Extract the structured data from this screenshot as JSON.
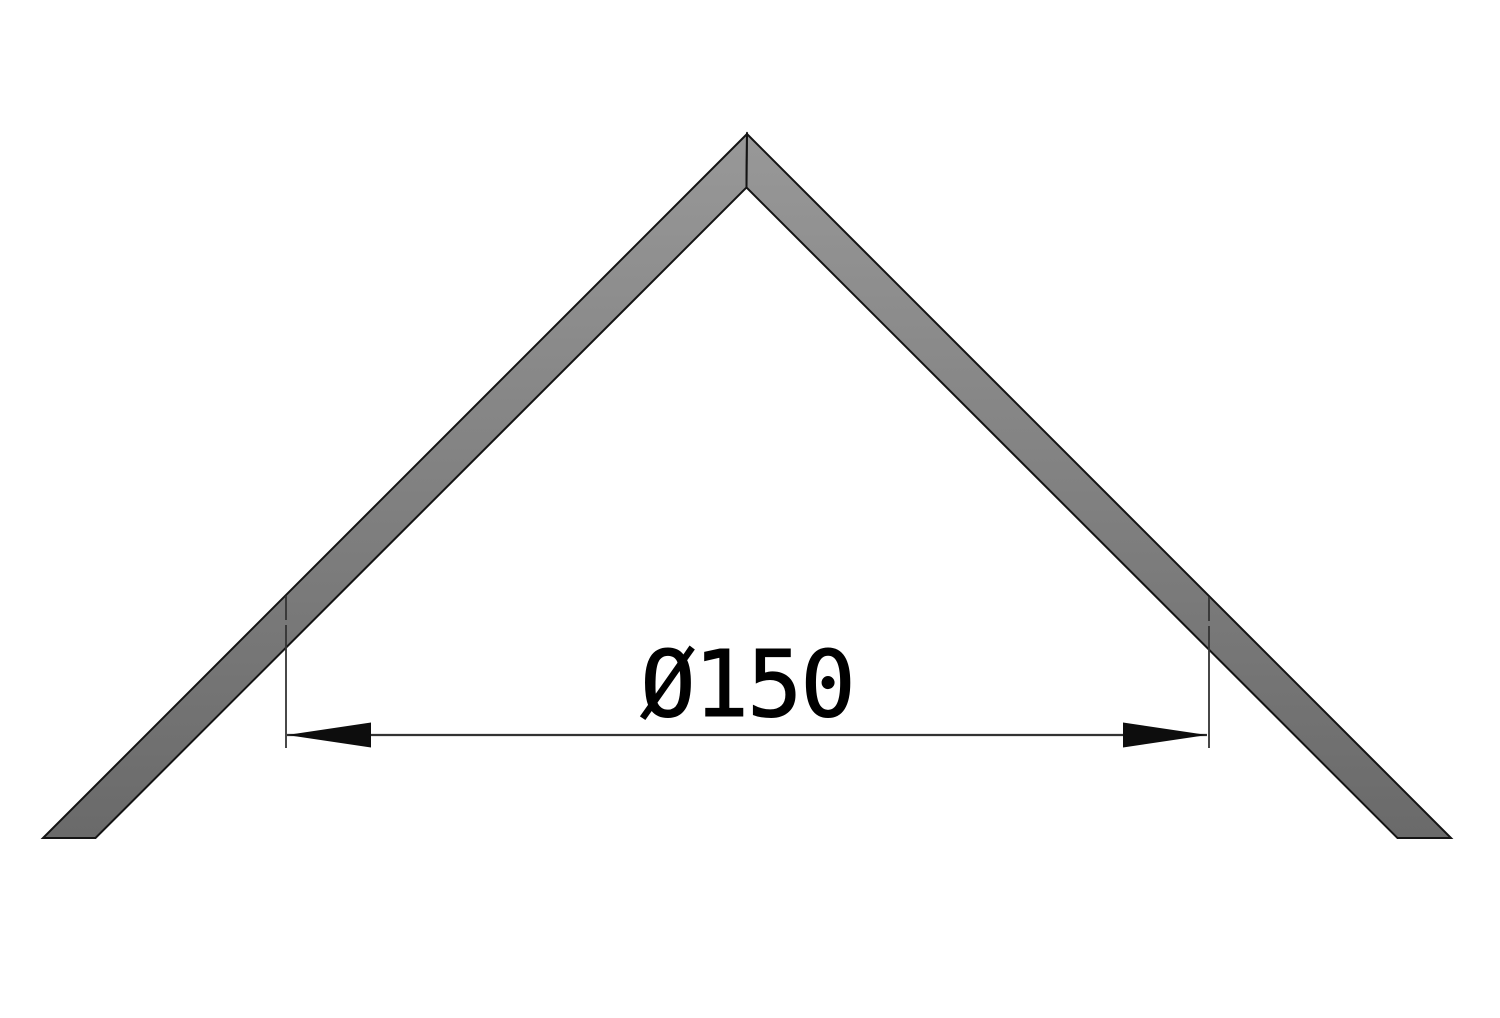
{
  "drawing": {
    "background_color": "#ffffff",
    "part": {
      "description": "mitered chevron section (cone apex), two 45-degree flanks",
      "outline_color": "#141414",
      "fill_top": "#989898",
      "fill_bottom": "#6a6a6a"
    },
    "dimension": {
      "label": "Ø150",
      "line_color": "#333333",
      "arrow_color": "#0d0d0d",
      "text_color": "#000000"
    }
  }
}
